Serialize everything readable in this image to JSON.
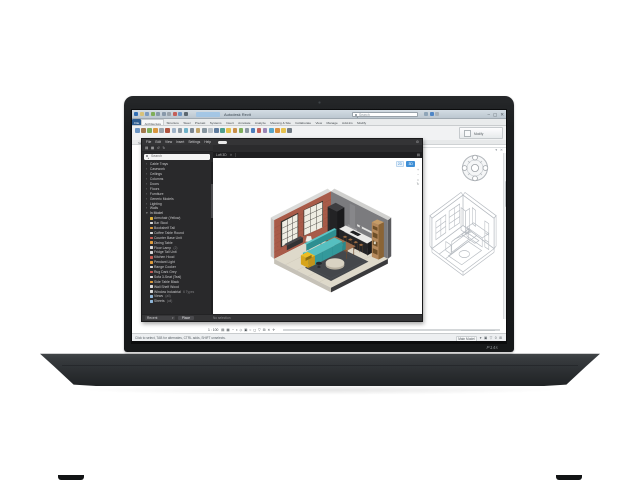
{
  "meta": {
    "description": "Laptop displaying a BIM / CAD workspace with a furnished loft 3D view and a wireframe axonometric view",
    "palette": {
      "brick_wall": "#a85b49",
      "back_wall": "#7b7b7e",
      "floor_wood": "#ded9ca",
      "rug": "#44474b",
      "sofa_teal": "#33999b",
      "armchair_yellow": "#d7a41b",
      "counter_black": "#242426",
      "shelf_wood": "#b5895b",
      "accent_blue": "#3f8fd6"
    }
  },
  "laptop": {
    "model_label": "P14s"
  },
  "titlebar": {
    "title": "Autodesk Revit",
    "search_placeholder": "Search",
    "qat": [
      {
        "name": "app-logo-icon",
        "color": "#2f6eb5"
      },
      {
        "name": "open-icon",
        "color": "#d8c27a"
      },
      {
        "name": "save-icon",
        "color": "#7d9bc0"
      },
      {
        "name": "sync-icon",
        "color": "#7fae5a"
      },
      {
        "name": "undo-icon",
        "color": "#8899aa"
      },
      {
        "name": "redo-icon",
        "color": "#8899aa"
      },
      {
        "name": "print-icon",
        "color": "#9aa3ab"
      },
      {
        "name": "measure-icon",
        "color": "#c4605a"
      },
      {
        "name": "tag-icon",
        "color": "#6d96c4"
      },
      {
        "name": "3d-view-icon",
        "color": "#5b6770"
      }
    ],
    "mini_icons": [
      {
        "name": "account-icon",
        "color": "#8fa5b8"
      },
      {
        "name": "help-icon",
        "color": "#4f86c6"
      },
      {
        "name": "apps-icon",
        "color": "#a9b2b9"
      }
    ],
    "controls": {
      "minimize": "–",
      "maximize": "▢",
      "close": "✕"
    }
  },
  "tabs": [
    {
      "label": "File",
      "cls": "file"
    },
    {
      "label": "Architecture",
      "cls": "active"
    },
    {
      "label": "Structure",
      "cls": ""
    },
    {
      "label": "Steel",
      "cls": ""
    },
    {
      "label": "Precast",
      "cls": ""
    },
    {
      "label": "Systems",
      "cls": ""
    },
    {
      "label": "Insert",
      "cls": ""
    },
    {
      "label": "Annotate",
      "cls": ""
    },
    {
      "label": "Analyze",
      "cls": ""
    },
    {
      "label": "Massing & Site",
      "cls": ""
    },
    {
      "label": "Collaborate",
      "cls": ""
    },
    {
      "label": "View",
      "cls": ""
    },
    {
      "label": "Manage",
      "cls": ""
    },
    {
      "label": "Add-Ins",
      "cls": ""
    },
    {
      "label": "Modify",
      "cls": ""
    }
  ],
  "ribbon": {
    "icons": [
      {
        "name": "wall-tool-icon",
        "color": "#6d96c4"
      },
      {
        "name": "door-tool-icon",
        "color": "#a3794e"
      },
      {
        "name": "window-tool-icon",
        "color": "#7fae5a"
      },
      {
        "name": "component-tool-icon",
        "color": "#d9963f"
      },
      {
        "name": "column-tool-icon",
        "color": "#9aa3ab"
      },
      {
        "name": "roof-tool-icon",
        "color": "#b0543f"
      },
      {
        "name": "ceiling-tool-icon",
        "color": "#9fb3c8"
      },
      {
        "name": "floor-tool-icon",
        "color": "#8d9aa5"
      },
      {
        "name": "curtain-tool-icon",
        "color": "#6fb2c9"
      },
      {
        "name": "grid-tool-icon",
        "color": "#7c8894"
      },
      {
        "name": "stairs-tool-icon",
        "color": "#c0a46b"
      },
      {
        "name": "railing-tool-icon",
        "color": "#86959f"
      },
      {
        "name": "ramp-tool-icon",
        "color": "#b7c0c7"
      },
      {
        "name": "model-text-icon",
        "color": "#5f7c9e"
      },
      {
        "name": "model-line-icon",
        "color": "#4e9e8f"
      },
      {
        "name": "room-tool-icon",
        "color": "#e3c04b"
      },
      {
        "name": "area-tool-icon",
        "color": "#c98f4a"
      },
      {
        "name": "tag-room-icon",
        "color": "#7fae5a"
      },
      {
        "name": "text-tool-icon",
        "color": "#8b98a2"
      },
      {
        "name": "dimension-tool-icon",
        "color": "#4d7fbd"
      },
      {
        "name": "section-tool-icon",
        "color": "#c4605a"
      },
      {
        "name": "callout-tool-icon",
        "color": "#9b86b5"
      },
      {
        "name": "view-3d-icon",
        "color": "#58a6c9"
      },
      {
        "name": "render-icon",
        "color": "#d98f3f"
      },
      {
        "name": "sun-settings-icon",
        "color": "#e6c24f"
      },
      {
        "name": "shadow-toggle-icon",
        "color": "#707a83"
      }
    ],
    "modify_label": "Modify",
    "panel_labels": [
      "Select ▾",
      "Properties",
      "Clipboard",
      "Geometry",
      "Modify",
      "View",
      "Measure",
      "Create"
    ]
  },
  "dark_window": {
    "menu": [
      "File",
      "Edit",
      "View",
      "Insert",
      "Settings",
      "Help"
    ],
    "gear": "⚙",
    "toolbar_icons": [
      "▤",
      "▦",
      "↺",
      "↻"
    ],
    "search_placeholder": "Search",
    "tree": {
      "categories": [
        "Cable Trays",
        "Casework",
        "Ceilings",
        "Columns",
        "Doors",
        "Floors",
        "Furniture",
        "Generic Models",
        "Lighting",
        "Walls"
      ],
      "group_header": "In Model",
      "items": [
        {
          "label": "Armchair (Yellow)",
          "color": "#e0b23a",
          "suffix": ""
        },
        {
          "label": "Bar Stool",
          "color": "#d8d8d8",
          "suffix": ""
        },
        {
          "label": "Bookshelf Tall",
          "color": "#dd9a3c",
          "suffix": ""
        },
        {
          "label": "Coffee Table Round",
          "color": "#d8d8d8",
          "suffix": ""
        },
        {
          "label": "Counter Base Unit",
          "color": "#c65b52",
          "suffix": ""
        },
        {
          "label": "Dining Table",
          "color": "#dd9a3c",
          "suffix": ""
        },
        {
          "label": "Floor Lamp",
          "color": "#d8d8d8",
          "suffix": "(2)"
        },
        {
          "label": "Fridge Tall Unit",
          "color": "#d8d8d8",
          "suffix": ""
        },
        {
          "label": "Kitchen Hood",
          "color": "#c65b52",
          "suffix": ""
        },
        {
          "label": "Pendant Light",
          "color": "#dd9a3c",
          "suffix": ""
        },
        {
          "label": "Range Cooker",
          "color": "#d8d8d8",
          "suffix": ""
        },
        {
          "label": "Rug Dark Grey",
          "color": "#c65b52",
          "suffix": ""
        },
        {
          "label": "Sofa 3-Seat (Teal)",
          "color": "#d8d8d8",
          "suffix": ""
        },
        {
          "label": "Side Table Black",
          "color": "#dd9a3c",
          "suffix": ""
        },
        {
          "label": "Wall Shelf Wood",
          "color": "#d8d8d8",
          "suffix": ""
        },
        {
          "label": "Window Industrial",
          "color": "#d8d8d8",
          "suffix": "6 Types"
        },
        {
          "label": "Views",
          "color": "#8fb6d9",
          "suffix": "(all)"
        },
        {
          "label": "Sheets",
          "color": "#8fb6d9",
          "suffix": "(all)"
        }
      ]
    },
    "canvas": {
      "tab_label": "Loft 3D",
      "tab_close": "✕",
      "menu_icon": "▤",
      "mode_2d": "2D",
      "mode_3d": "3D",
      "zoom_stack": [
        "+",
        "−",
        "⌂",
        "↻"
      ]
    },
    "bottombar": {
      "recent_label": "Recent",
      "recent_caret": "▾",
      "place_label": "Place",
      "status": "No selection"
    }
  },
  "viewbar": {
    "scale": "1 : 100",
    "icons": [
      "▤",
      "▦",
      "◔",
      "◑",
      "◇",
      "▣",
      "○",
      "◻",
      "▽",
      "⊞",
      "✕",
      "✛"
    ]
  },
  "statusbar": {
    "left_text": "Click to select, TAB for alternates, CTRL adds, SHIFT unselects.",
    "main_model_label": "Main Model",
    "right_icons": [
      "▾",
      "▣",
      "▽",
      "0",
      "⊞"
    ]
  },
  "workarea_corner_icons": "▾ ✕"
}
